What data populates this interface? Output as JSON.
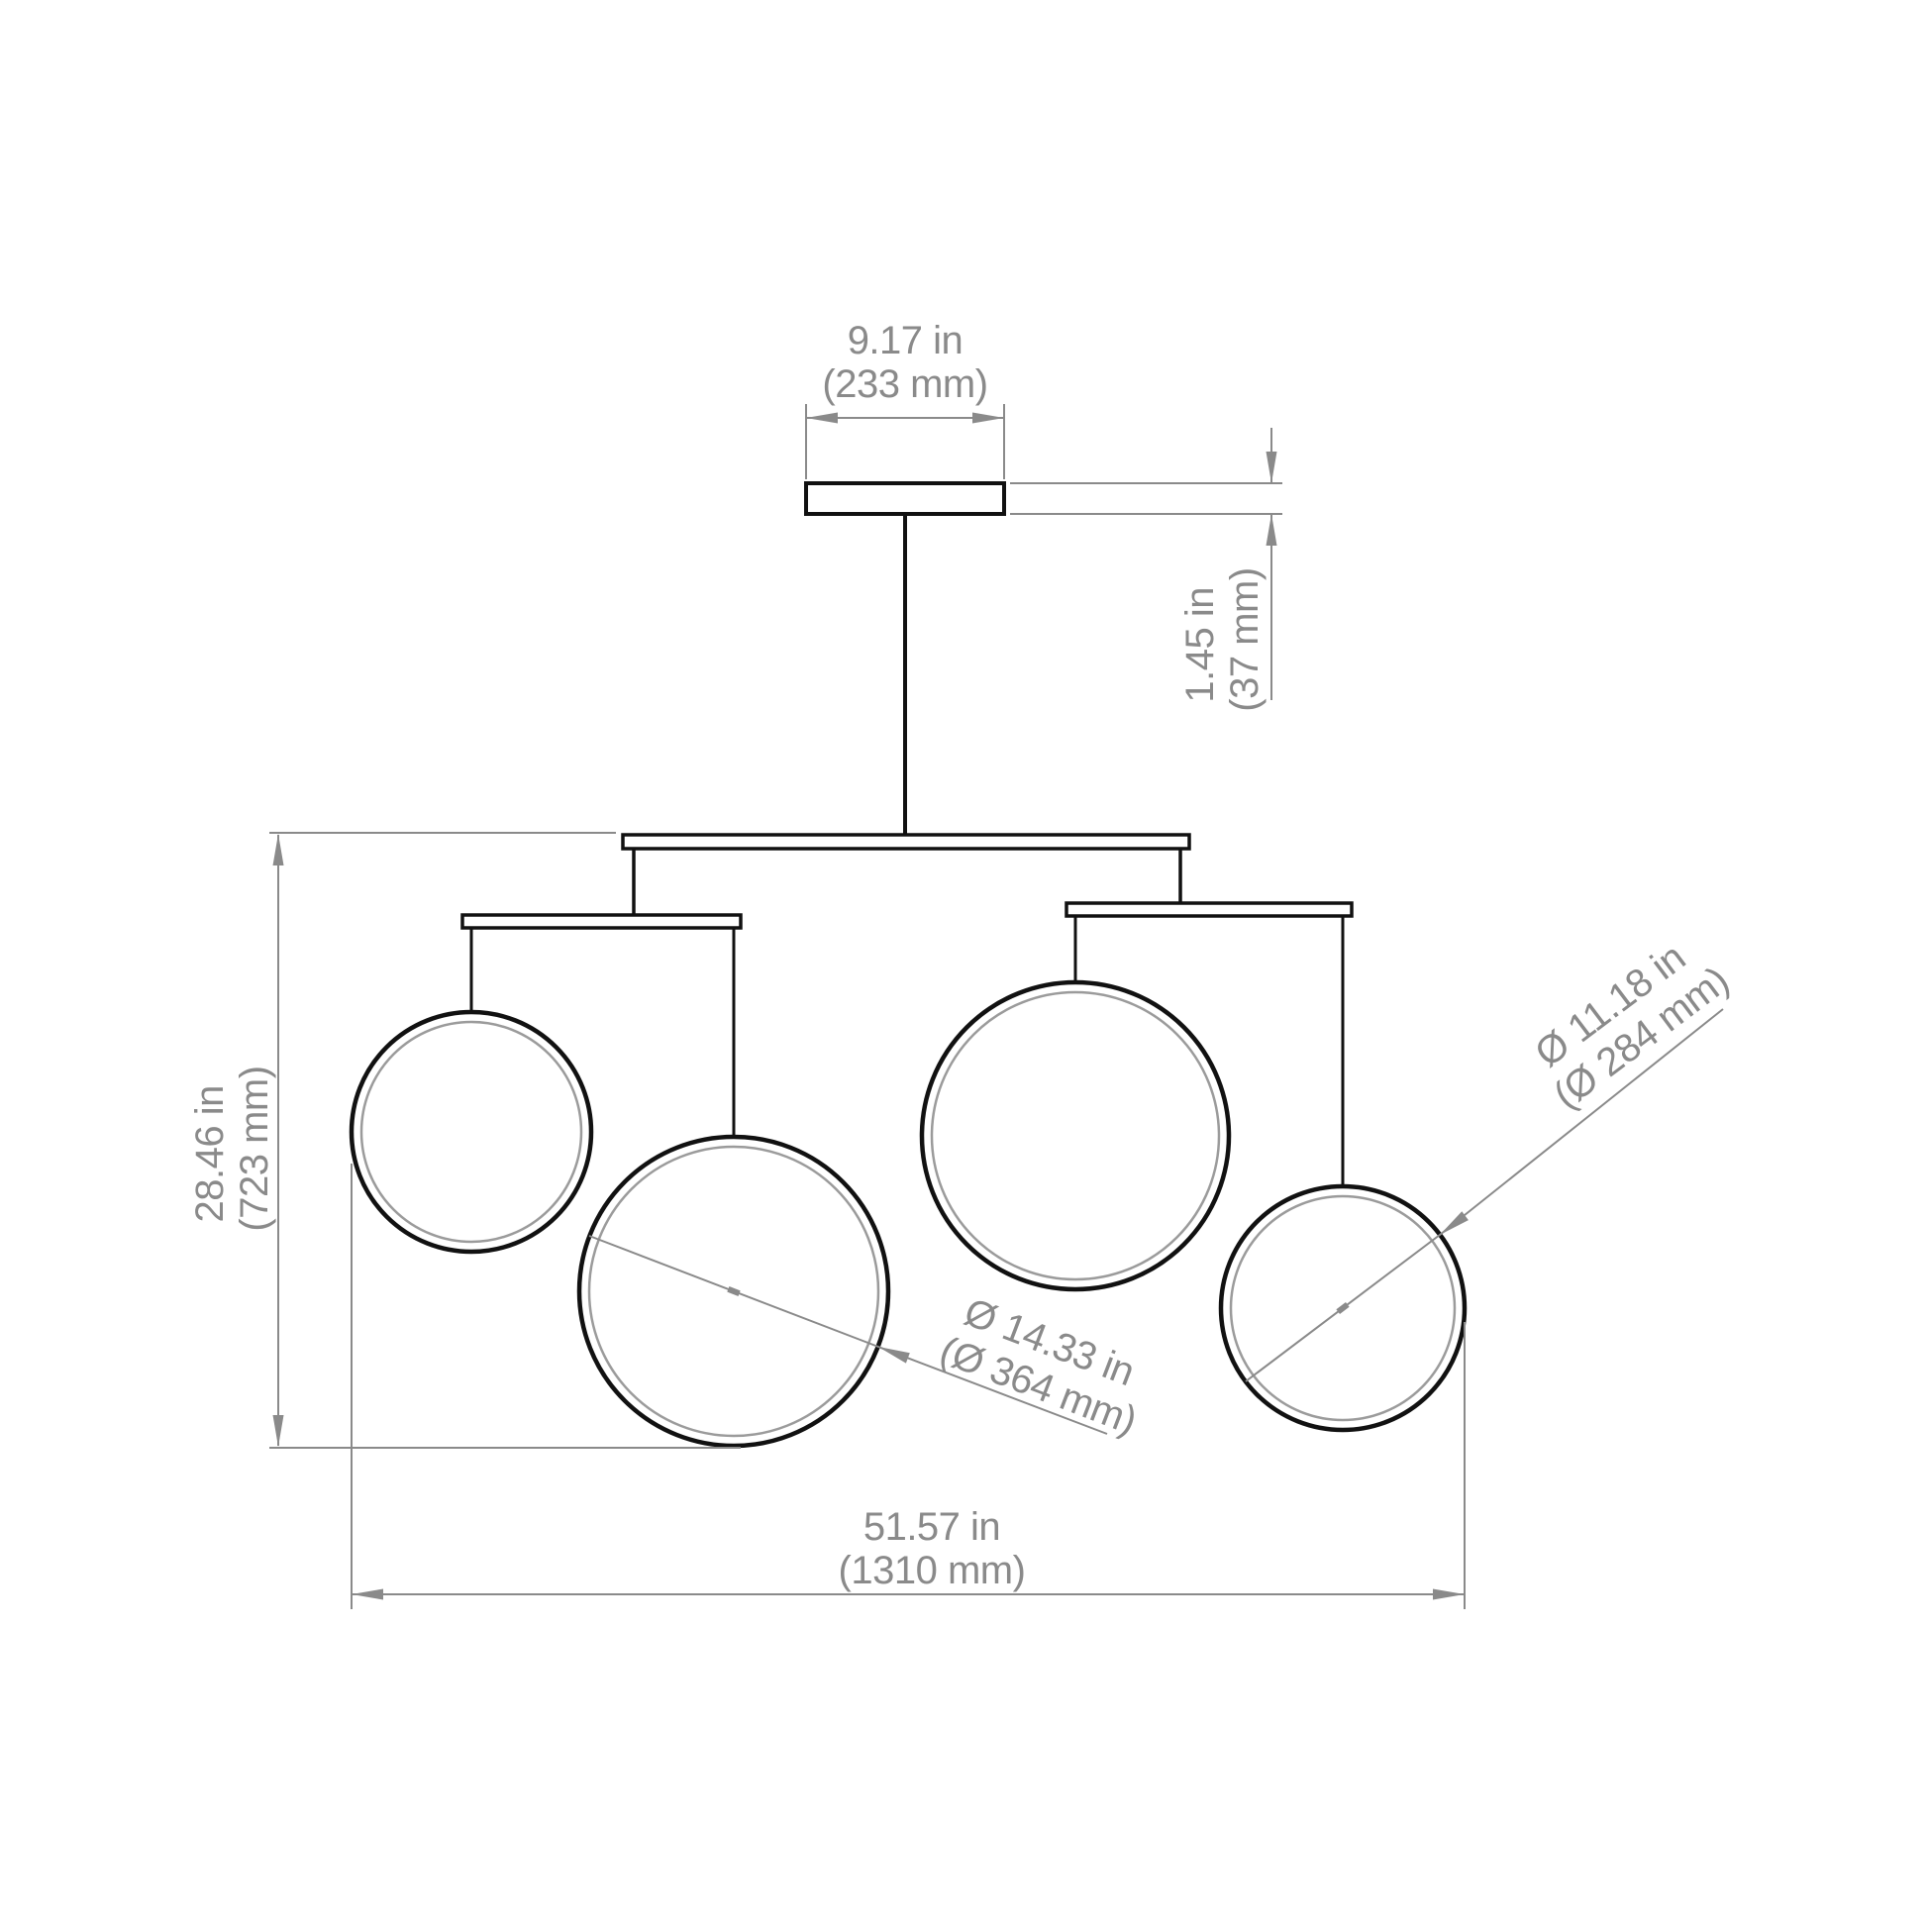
{
  "drawing": {
    "kind": "pendant-chandelier-dimension-drawing",
    "units": [
      "in",
      "mm"
    ]
  },
  "dimensions": {
    "canopy_width": {
      "imperial": "9.17 in",
      "metric": "(233 mm)"
    },
    "canopy_height": {
      "imperial": "1.45 in",
      "metric": "(37 mm)"
    },
    "fixture_height": {
      "imperial": "28.46 in",
      "metric": "(723 mm)"
    },
    "fixture_width": {
      "imperial": "51.57 in",
      "metric": "(1310 mm)"
    },
    "large_ring_diameter": {
      "imperial": "Ø 14.33 in",
      "metric": "(Ø 364 mm)"
    },
    "small_ring_diameter": {
      "imperial": "Ø 11.18 in",
      "metric": "(Ø 284 mm)"
    }
  },
  "colors": {
    "line": "#111111",
    "dim": "#8a8a8a",
    "ring_inner": "#9b9b9b",
    "background": "#ffffff"
  }
}
